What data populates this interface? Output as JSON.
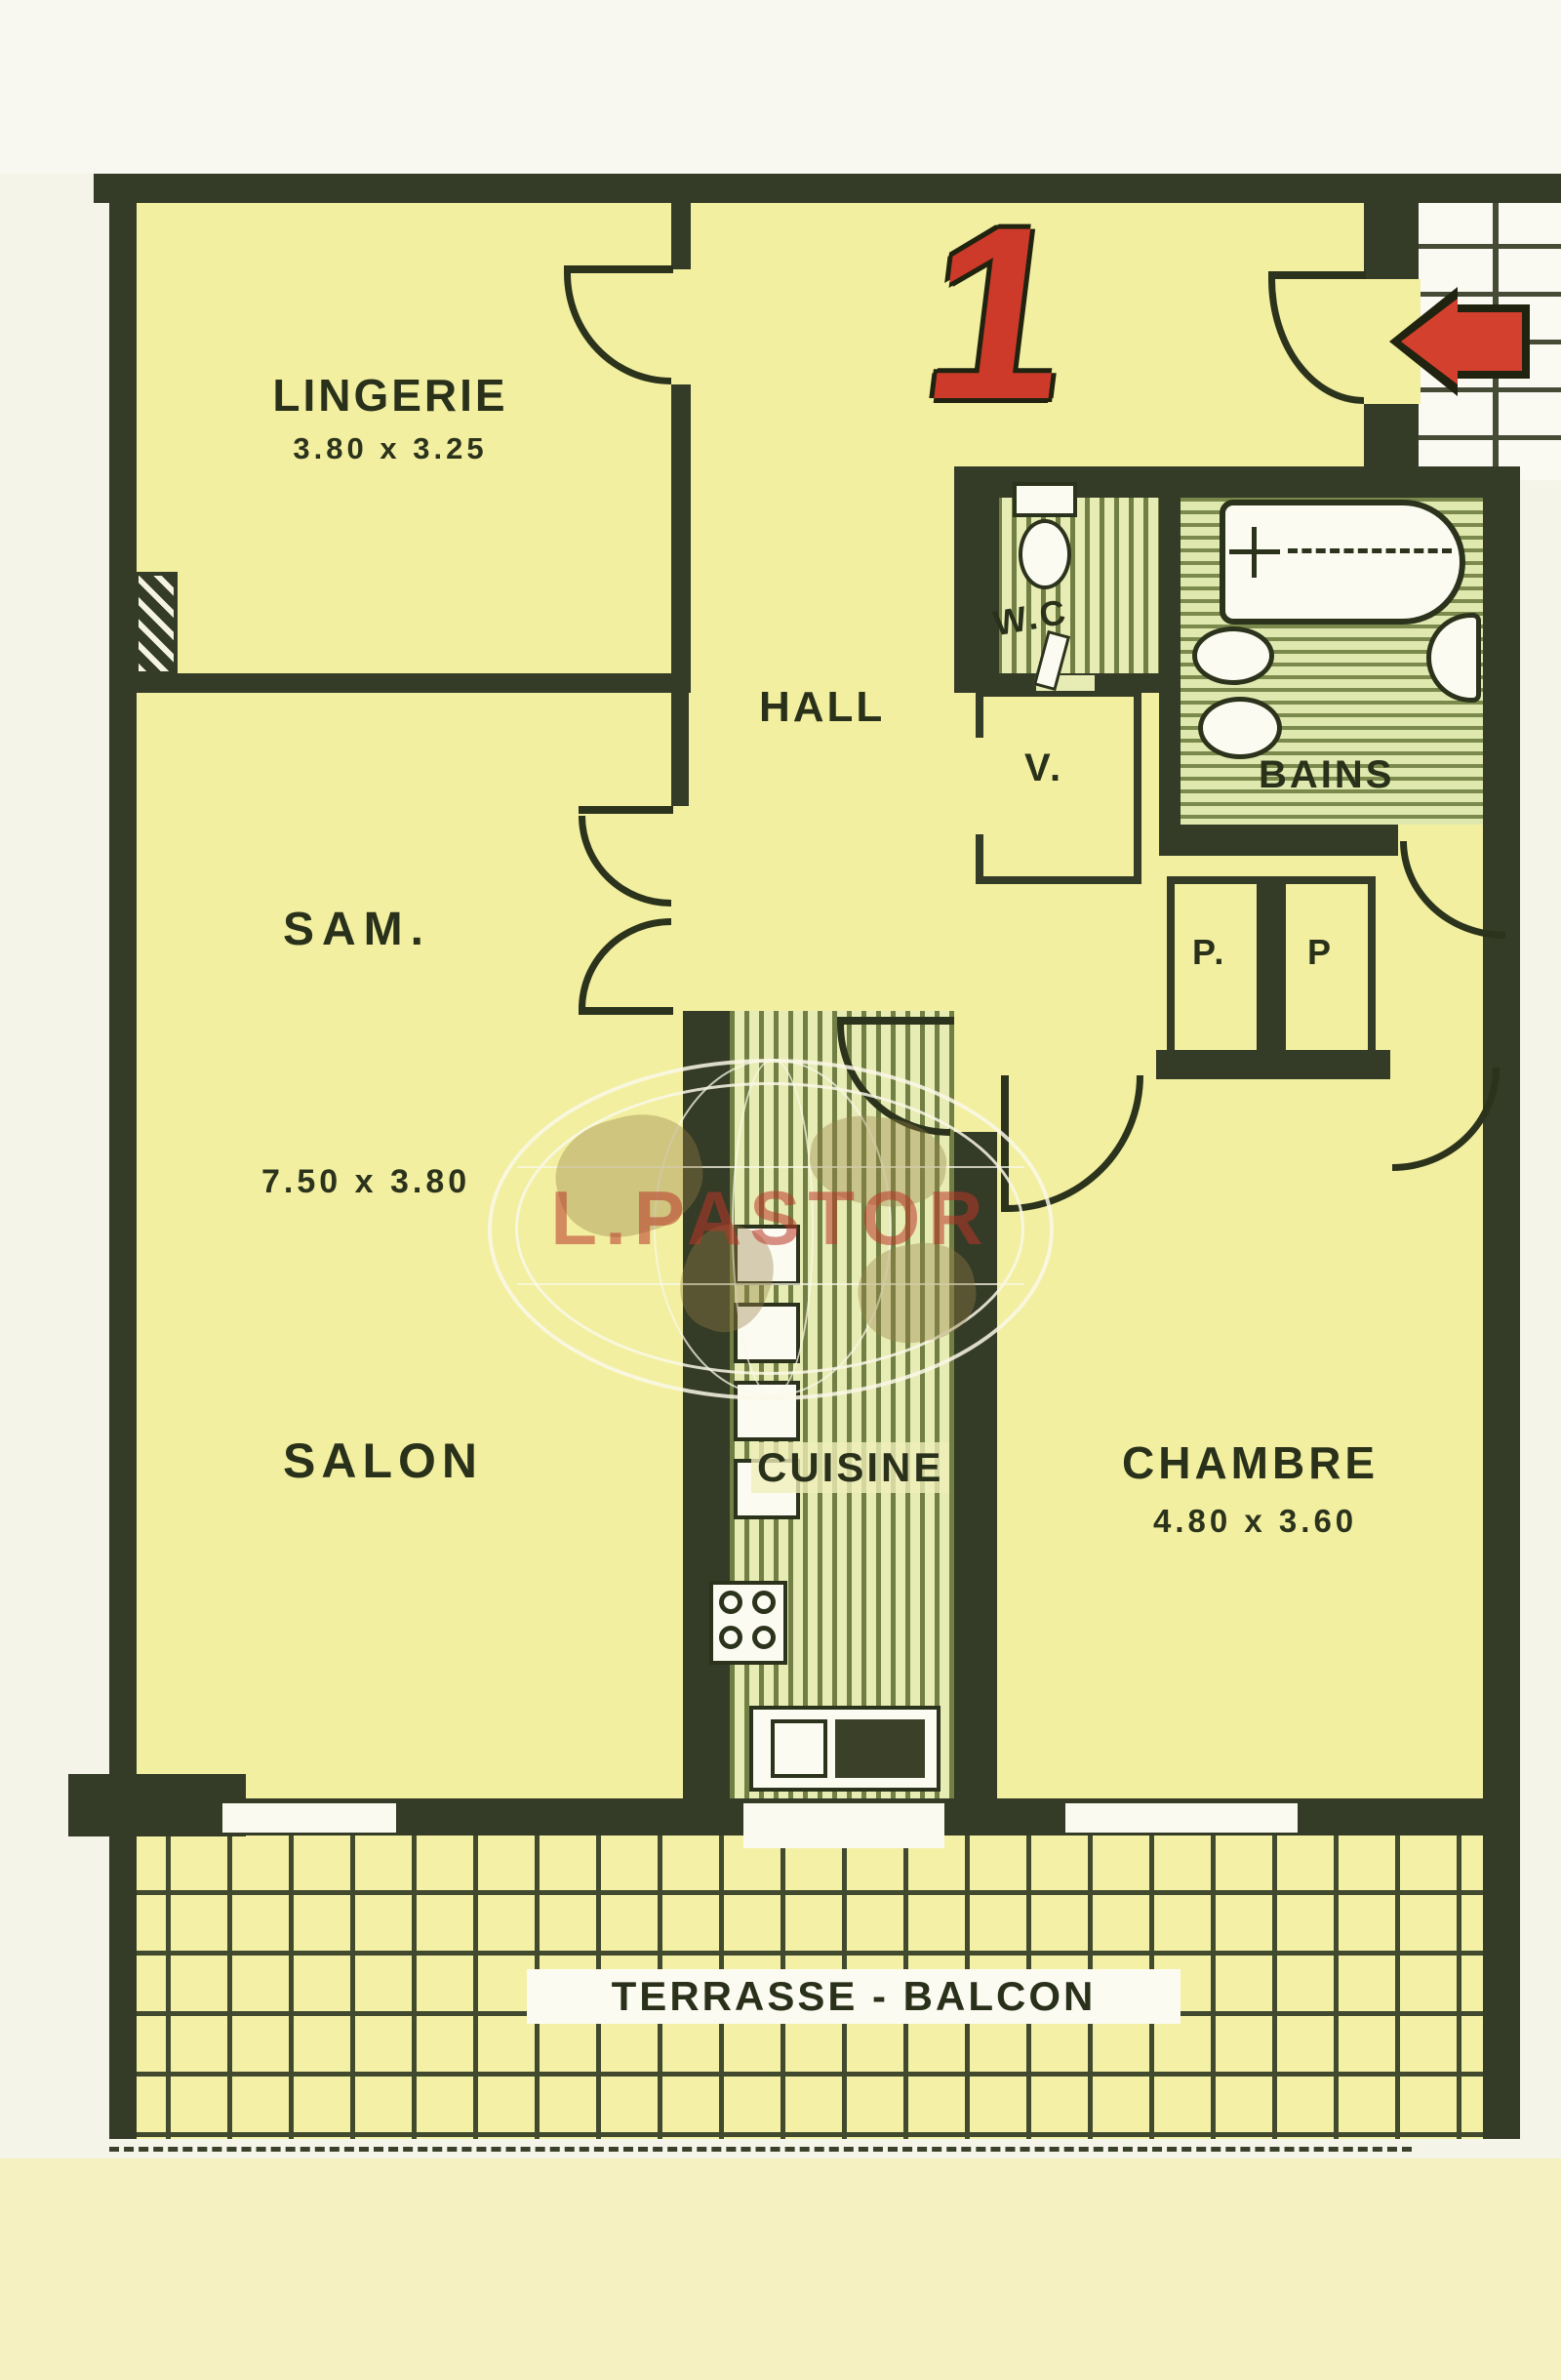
{
  "plan_title_number": "1",
  "watermark_text": "L.PASTOR",
  "rooms": {
    "lingerie": {
      "label": "LINGERIE",
      "dims": "3.80 x 3.25"
    },
    "hall": {
      "label": "HALL"
    },
    "wc": {
      "label": "W.C"
    },
    "bains": {
      "label": "BAINS"
    },
    "closet_v": {
      "label": "V."
    },
    "sam": {
      "label": "SAM.",
      "dims": "7.50 x 3.80"
    },
    "closet_p_left": {
      "label": "P."
    },
    "closet_p_right": {
      "label": "P"
    },
    "salon": {
      "label": "SALON"
    },
    "cuisine": {
      "label": "CUISINE"
    },
    "chambre": {
      "label": "CHAMBRE",
      "dims": "4.80 x 3.60"
    },
    "terrasse": {
      "label": "TERRASSE - BALCON"
    }
  },
  "colors": {
    "room_fill": "#f2efa0",
    "wall": "#343b26",
    "accent_red": "#d4402e",
    "hatch_green": "#76844a",
    "terrace_grid": "#414a2e",
    "watermark_red": "rgba(185,55,40,0.55)"
  }
}
